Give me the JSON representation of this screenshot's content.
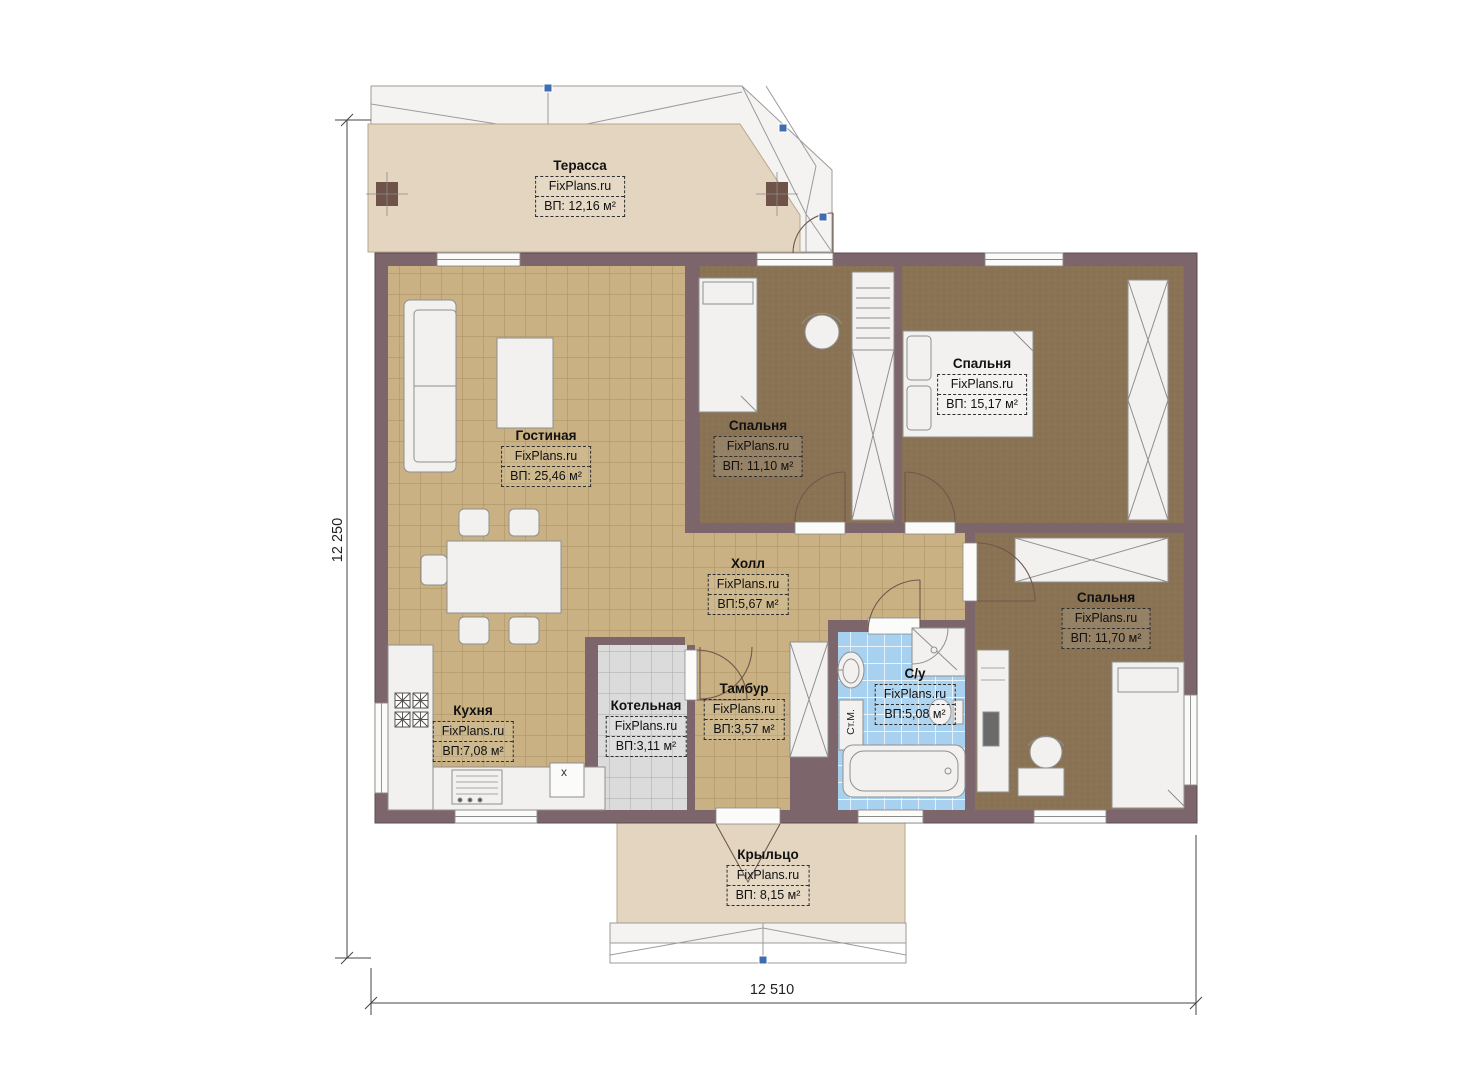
{
  "brand": "FixPlans.ru",
  "rooms": {
    "terrace": {
      "name": "Терасса",
      "area": "ВП: 12,16 м²"
    },
    "living": {
      "name": "Гостиная",
      "area": "ВП: 25,46 м²"
    },
    "bedroom_top_middle": {
      "name": "Спальня",
      "area": "ВП: 11,10 м²"
    },
    "bedroom_top_right": {
      "name": "Спальня",
      "area": "ВП: 15,17 м²"
    },
    "hall": {
      "name": "Холл",
      "area": "ВП:5,67 м²"
    },
    "bedroom_bottom_right": {
      "name": "Спальня",
      "area": "ВП: 11,70 м²"
    },
    "kitchen": {
      "name": "Кухня",
      "area": "ВП:7,08 м²"
    },
    "boiler": {
      "name": "Котельная",
      "area": "ВП:3,11 м²"
    },
    "vestibule": {
      "name": "Тамбур",
      "area": "ВП:3,57 м²"
    },
    "bathroom": {
      "name": "С/у",
      "area": "ВП:5,08 м²"
    },
    "porch": {
      "name": "Крыльцо",
      "area": "ВП: 8,15 м²"
    }
  },
  "dimensions": {
    "left": "12 250",
    "bottom": "12 510"
  },
  "annotations": {
    "washing_machine": "Ст.М.",
    "kitchen_mark": "x"
  },
  "colors": {
    "wall": "#7c666c",
    "floor_tile_tan": "#c9b183",
    "floor_carpet_brown": "#8a7354",
    "floor_tile_blue": "#a8d1f0",
    "floor_tile_gray": "#dbdbdb",
    "deck_beige": "#e3d5bf",
    "roof_white": "#f4f3f1",
    "grip_blue": "#3d6fb0"
  }
}
